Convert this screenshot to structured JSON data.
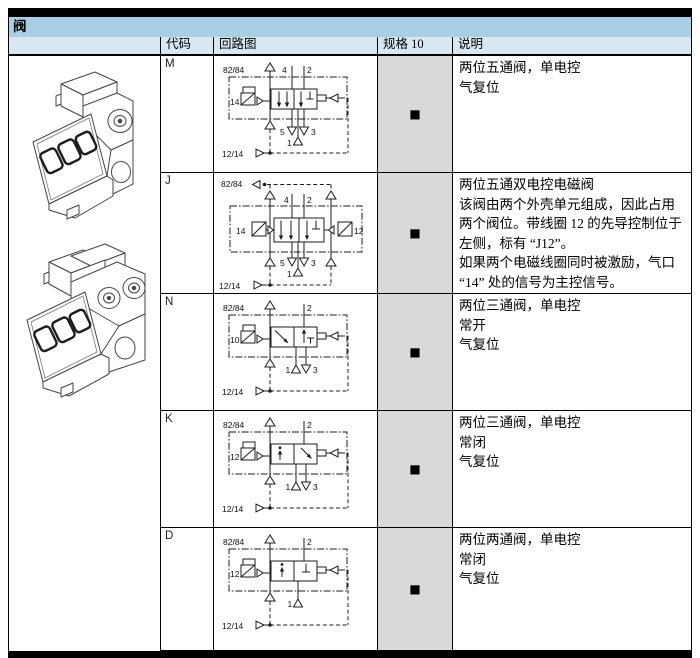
{
  "page": {
    "title": "阀"
  },
  "colors": {
    "title_band": "#a9cfe4",
    "header_band": "#d7e8f3",
    "spec_cell_bg": "#d9d9d9",
    "rule_black": "#000000"
  },
  "table": {
    "headers": {
      "code": "代码",
      "circuit": "回路图",
      "spec": "规格 10",
      "desc": "说明"
    },
    "spec_marker": "■",
    "rows": [
      {
        "code": "M",
        "valve_type": "5/2 single solenoid",
        "spec10": "available",
        "desc": [
          "两位五通阀，单电控",
          "气复位"
        ],
        "diagram": {
          "top_pilot": "82/84",
          "port4": "4",
          "port2": "2",
          "sol": "14",
          "port5": "5",
          "port3": "3",
          "port1": "1",
          "bottom_pilot": "12/14"
        }
      },
      {
        "code": "J",
        "valve_type": "5/2 double solenoid",
        "spec10": "available",
        "desc": [
          "两位五通双电控电磁阀",
          "该阀由两个外壳单元组成，因此占用两个阀位。带线圈 12 的先导控制位于左侧，标有 “J12”。",
          "如果两个电磁线圈同时被激励，气口 “14” 处的信号为主控信号。"
        ],
        "diagram": {
          "top_pilot": "82/84",
          "port4": "4",
          "port2": "2",
          "sol_left": "14",
          "sol_right": "12",
          "port5": "5",
          "port3": "3",
          "port1": "1",
          "bottom_pilot": "12/14"
        }
      },
      {
        "code": "N",
        "valve_type": "3/2 single solenoid normally open",
        "spec10": "available",
        "desc": [
          "两位三通阀，单电控",
          "常开",
          "气复位"
        ],
        "diagram": {
          "top_pilot": "82/84",
          "port2": "2",
          "sol": "10",
          "port1": "1",
          "port3": "3",
          "bottom_pilot": "12/14"
        }
      },
      {
        "code": "K",
        "valve_type": "3/2 single solenoid normally closed",
        "spec10": "available",
        "desc": [
          "两位三通阀，单电控",
          "常闭",
          "气复位"
        ],
        "diagram": {
          "top_pilot": "82/84",
          "port2": "2",
          "sol": "12",
          "port1": "1",
          "port3": "3",
          "bottom_pilot": "12/14"
        }
      },
      {
        "code": "D",
        "valve_type": "2/2 single solenoid normally closed",
        "spec10": "available",
        "desc": [
          "两位两通阀，单电控",
          "常闭",
          "气复位"
        ],
        "diagram": {
          "top_pilot": "82/84",
          "port2": "2",
          "sol": "12",
          "port1": "1",
          "bottom_pilot": "12/14"
        }
      }
    ]
  }
}
